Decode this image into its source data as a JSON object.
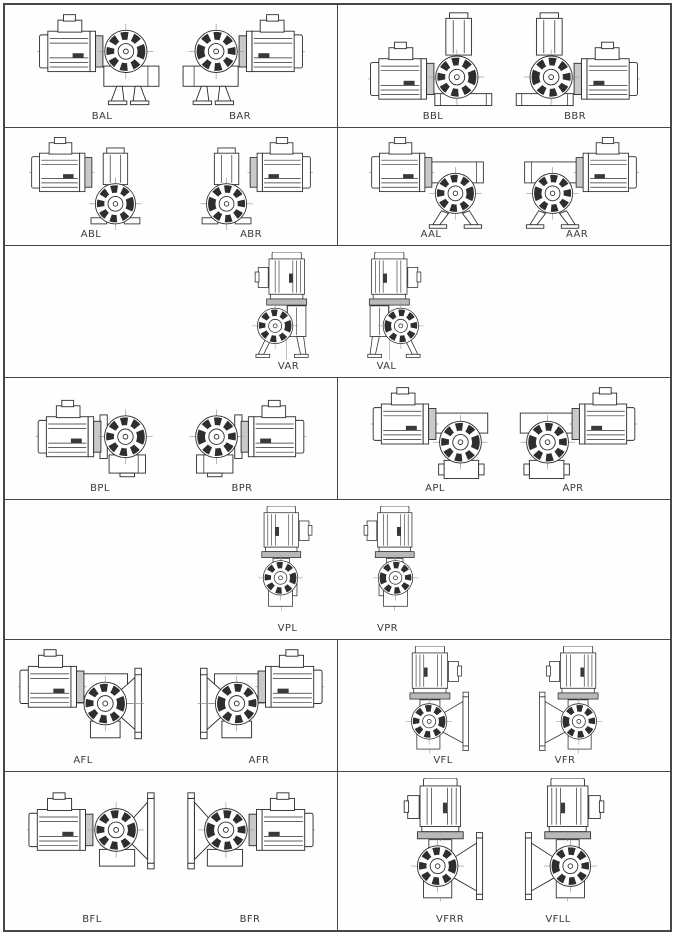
{
  "colors": {
    "line": "#2e2e2e",
    "centerline": "#909090",
    "grid_border": "#474747",
    "background": "#ffffff",
    "label_text": "#3a3a3a",
    "flange_fill": "#c9c9c9"
  },
  "rows": [
    {
      "cells": [
        {
          "figures": [
            {
              "label": "BAL",
              "type": "BA",
              "mirror": false
            },
            {
              "label": "BAR",
              "type": "BA",
              "mirror": true
            }
          ]
        },
        {
          "figures": [
            {
              "label": "BBL",
              "type": "BB",
              "mirror": false
            },
            {
              "label": "BBR",
              "type": "BB",
              "mirror": true
            }
          ]
        }
      ]
    },
    {
      "cells": [
        {
          "figures": [
            {
              "label": "ABL",
              "type": "AB",
              "mirror": false
            },
            {
              "label": "ABR",
              "type": "AB",
              "mirror": true
            }
          ]
        },
        {
          "figures": [
            {
              "label": "AAL",
              "type": "AA",
              "mirror": false
            },
            {
              "label": "AAR",
              "type": "AA",
              "mirror": true
            }
          ]
        }
      ]
    },
    {
      "cells": [
        {
          "figures": [
            {
              "label": "VAR",
              "type": "VA",
              "mirror": false
            },
            {
              "label": "VAL",
              "type": "VA",
              "mirror": true
            }
          ]
        }
      ]
    },
    {
      "cells": [
        {
          "figures": [
            {
              "label": "BPL",
              "type": "BP",
              "mirror": false
            },
            {
              "label": "BPR",
              "type": "BP",
              "mirror": true
            }
          ]
        },
        {
          "figures": [
            {
              "label": "APL",
              "type": "AP",
              "mirror": false
            },
            {
              "label": "APR",
              "type": "AP",
              "mirror": true
            }
          ]
        }
      ]
    },
    {
      "cells": [
        {
          "figures": [
            {
              "label": "VPL",
              "type": "VP",
              "mirror": false
            },
            {
              "label": "VPR",
              "type": "VP",
              "mirror": true
            }
          ]
        }
      ]
    },
    {
      "cells": [
        {
          "figures": [
            {
              "label": "AFL",
              "type": "AF",
              "mirror": false
            },
            {
              "label": "AFR",
              "type": "AF",
              "mirror": true
            }
          ]
        },
        {
          "figures": [
            {
              "label": "VFL",
              "type": "VF",
              "mirror": false
            },
            {
              "label": "VFR",
              "type": "VF",
              "mirror": true
            }
          ]
        }
      ]
    },
    {
      "cells": [
        {
          "figures": [
            {
              "label": "BFL",
              "type": "BF",
              "mirror": false
            },
            {
              "label": "BFR",
              "type": "BF",
              "mirror": true
            }
          ]
        },
        {
          "figures": [
            {
              "label": "VFRR",
              "type": "VFF",
              "mirror": false
            },
            {
              "label": "VFLL",
              "type": "VFF",
              "mirror": true
            }
          ]
        }
      ]
    }
  ]
}
